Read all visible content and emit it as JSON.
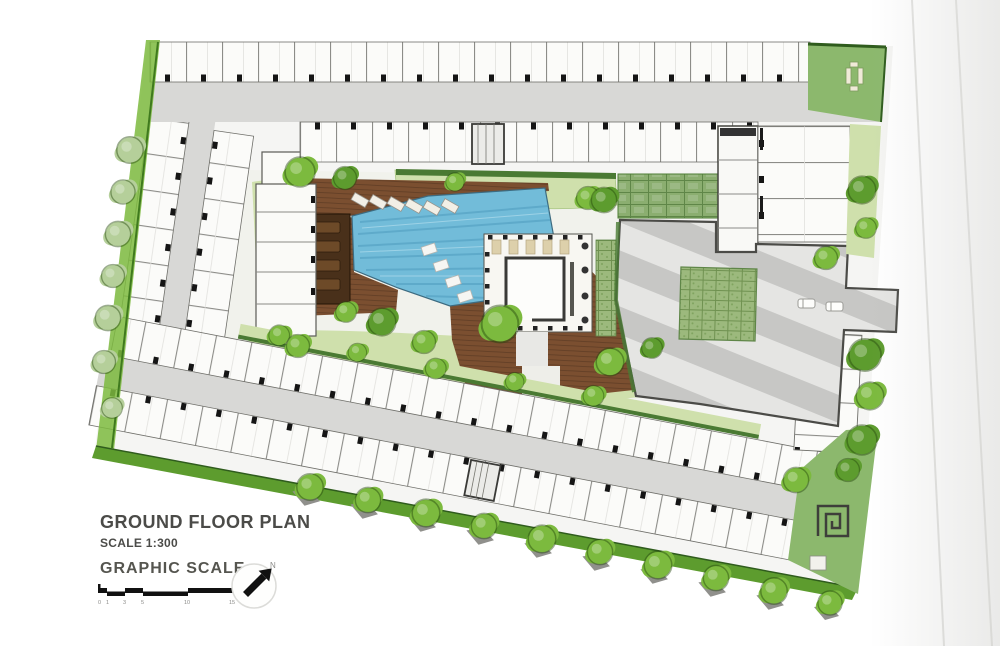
{
  "title_block": {
    "title": "GROUND FLOOR PLAN",
    "scale_label": "SCALE 1:300",
    "graphic_scale_label": "GRAPHIC SCALE"
  },
  "scale_bar": {
    "ticks": [
      "0",
      "1",
      "3",
      "5",
      "10",
      "15"
    ]
  },
  "north_arrow": {
    "label": "N"
  },
  "colors": {
    "paper": "#ffffff",
    "shade": "#e9e9e6",
    "site": "#f5f5f3",
    "unit": "#fbfbf9",
    "wall": "#6f6f6a",
    "corridor": "#d8d8d6",
    "stripe_dark": "#c7c7c5",
    "stripe_light": "#e5e5e3",
    "road": "#dcdcda",
    "pool": "#72bcd9",
    "pool_dark": "#4f9cbe",
    "pool_light": "#a8d8ea",
    "deck": "#7b4f30",
    "deck_dark": "#49301a",
    "lawn": "#cfe0ac",
    "hedge": "#4a7a33",
    "paver": "#9cb97d",
    "pergola": "#8bae70",
    "garden": "#8cb86d",
    "tree_bright": "#7cba3e",
    "tree_mid": "#5d9c2e",
    "tree_pale": "#b5cf9a",
    "ink": "#4b4b48"
  }
}
